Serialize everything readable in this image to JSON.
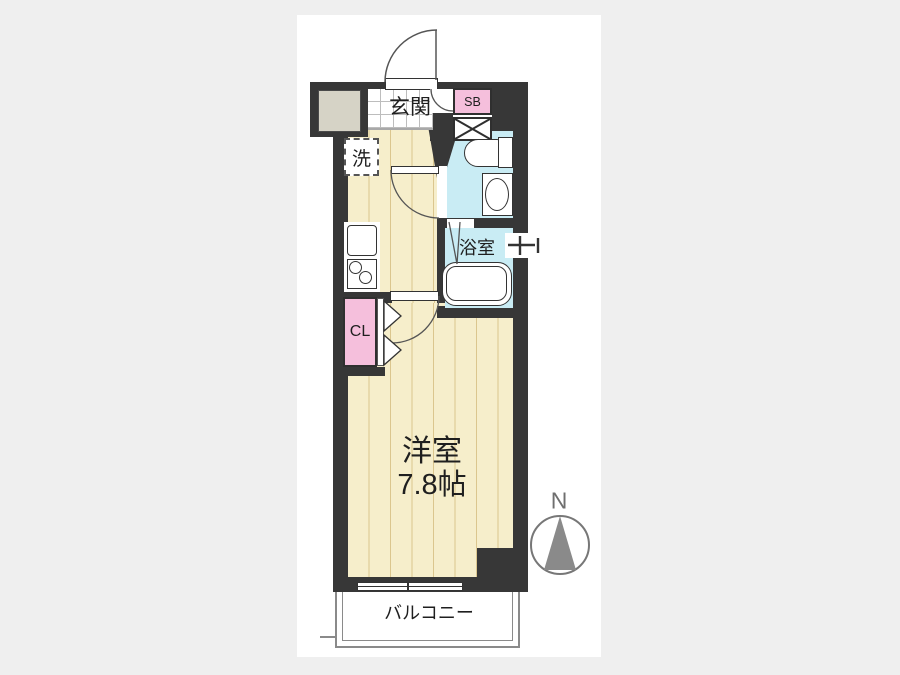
{
  "floorplan": {
    "labels": {
      "entrance": "玄関",
      "shoe_box": "SB",
      "laundry": "洗",
      "bathroom": "浴室",
      "closet": "CL",
      "room_name": "洋室",
      "room_size": "7.8帖",
      "balcony": "バルコニー",
      "north": "N"
    },
    "colors": {
      "background": "#efefef",
      "panel": "#ffffff",
      "wall": "#373737",
      "flooring": "#f6eecb",
      "floor_stripe": "#dbc68e",
      "wet_area_blue": "#c9ecf4",
      "accent_pink": "#f5bfdc",
      "tile_grid": "#bdbdbd",
      "outline_gray": "#8a8a8a"
    },
    "symbols": [
      "entrance-door-swing",
      "shoe-box-door-swing",
      "pipe-space-x",
      "toilet",
      "washbasin",
      "bathtub",
      "bath-faucet",
      "kitchen-sink",
      "two-burner-stove",
      "washing-machine-space",
      "closet-bifold-door",
      "room-door-swing",
      "bathroom-folding-door",
      "sliding-window",
      "north-arrow"
    ]
  }
}
